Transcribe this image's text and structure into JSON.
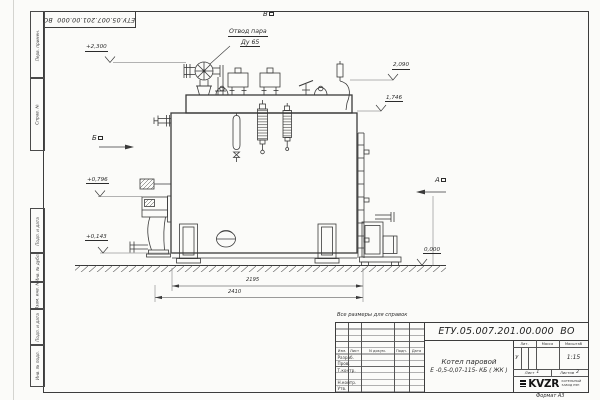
{
  "frame": {
    "stamp_code": "ЕТУ.05.007.201.00.000  ВО",
    "format_note": "Формат А3",
    "margin_cells": {
      "perv_primen": "Перв. примен.",
      "sprav_no": "Справ. №",
      "podp_data_1": "Подп. и дата",
      "inv_dubl": "Инв. № дубл.",
      "vzam_inv": "Взам. инв. №",
      "podp_data_2": "Подп. и дата",
      "inv_podl": "Инв. № подл."
    }
  },
  "drawing": {
    "callouts": {
      "steam_outlet_line1": "Отвод пара",
      "steam_outlet_line2": "Ду 65"
    },
    "view_markers": {
      "a": "А",
      "b": "Б",
      "v": "В"
    },
    "elevations": {
      "e2300": "+2,300",
      "e2090": "2,090",
      "e1746": "1,746",
      "e0796": "+0,796",
      "e0143": "+0,143",
      "e0000": "0,000"
    },
    "dimensions": {
      "length_inner": "2195",
      "length_overall": "2410"
    }
  },
  "notes": {
    "reference": "Все размеры для справок"
  },
  "title_block": {
    "doc_number": "ЕТУ.05.007.201.00.000  ВО",
    "product_line1": "Котел паровой",
    "product_line2": "Е -0,5-0,07-115- КБ ( ЖК )",
    "header_cols": {
      "izm": "Изм.",
      "list": "Лист",
      "doc": "N докум.",
      "podp": "Подп.",
      "data": "Дата"
    },
    "sign_rows": {
      "razrab": "Разраб.",
      "prov": "Пров.",
      "tkontr": "Т.контр.",
      "nkontr": "Н.контр.",
      "utv": "Утв."
    },
    "lit_label": "Лит.",
    "lit_value": "У",
    "mass_label": "Масса",
    "scale_label": "Масштаб",
    "scale_value": "1:15",
    "sheet_label": "Лист",
    "sheet_value": "1",
    "sheets_label": "Листов",
    "sheets_value": "2",
    "logo_text": "KVZR",
    "logo_sub1": "КОТЕЛЬНЫЙ",
    "logo_sub2": "ЗАВОД РЭП"
  }
}
